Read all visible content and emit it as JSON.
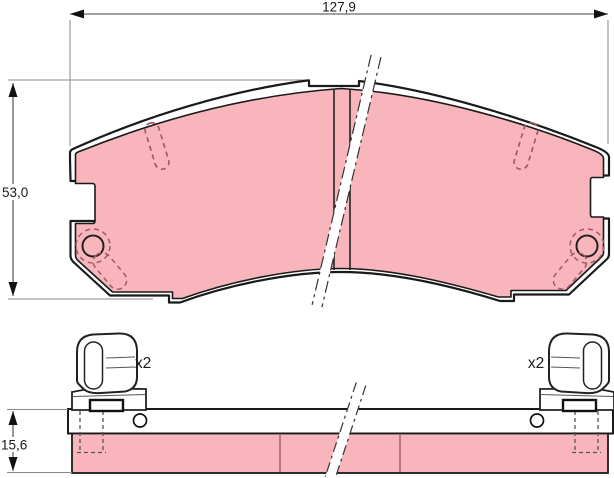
{
  "diagram": {
    "type": "technical-drawing",
    "subject": "disc-brake-pad-set-with-accessory-clips",
    "views": [
      "top-view-pad",
      "side-view-assembly"
    ],
    "dimensions": {
      "width_label": "127,9",
      "height_label": "53,0",
      "thickness_label": "15,6"
    },
    "clips": {
      "left_qty_label": "x2",
      "right_qty_label": "x2"
    },
    "colors": {
      "friction_material": "#f8b6bc",
      "outline": "#1a1a1a",
      "hidden_line": "#a05a62",
      "dimension_line": "#555555",
      "background": "#ffffff"
    }
  }
}
